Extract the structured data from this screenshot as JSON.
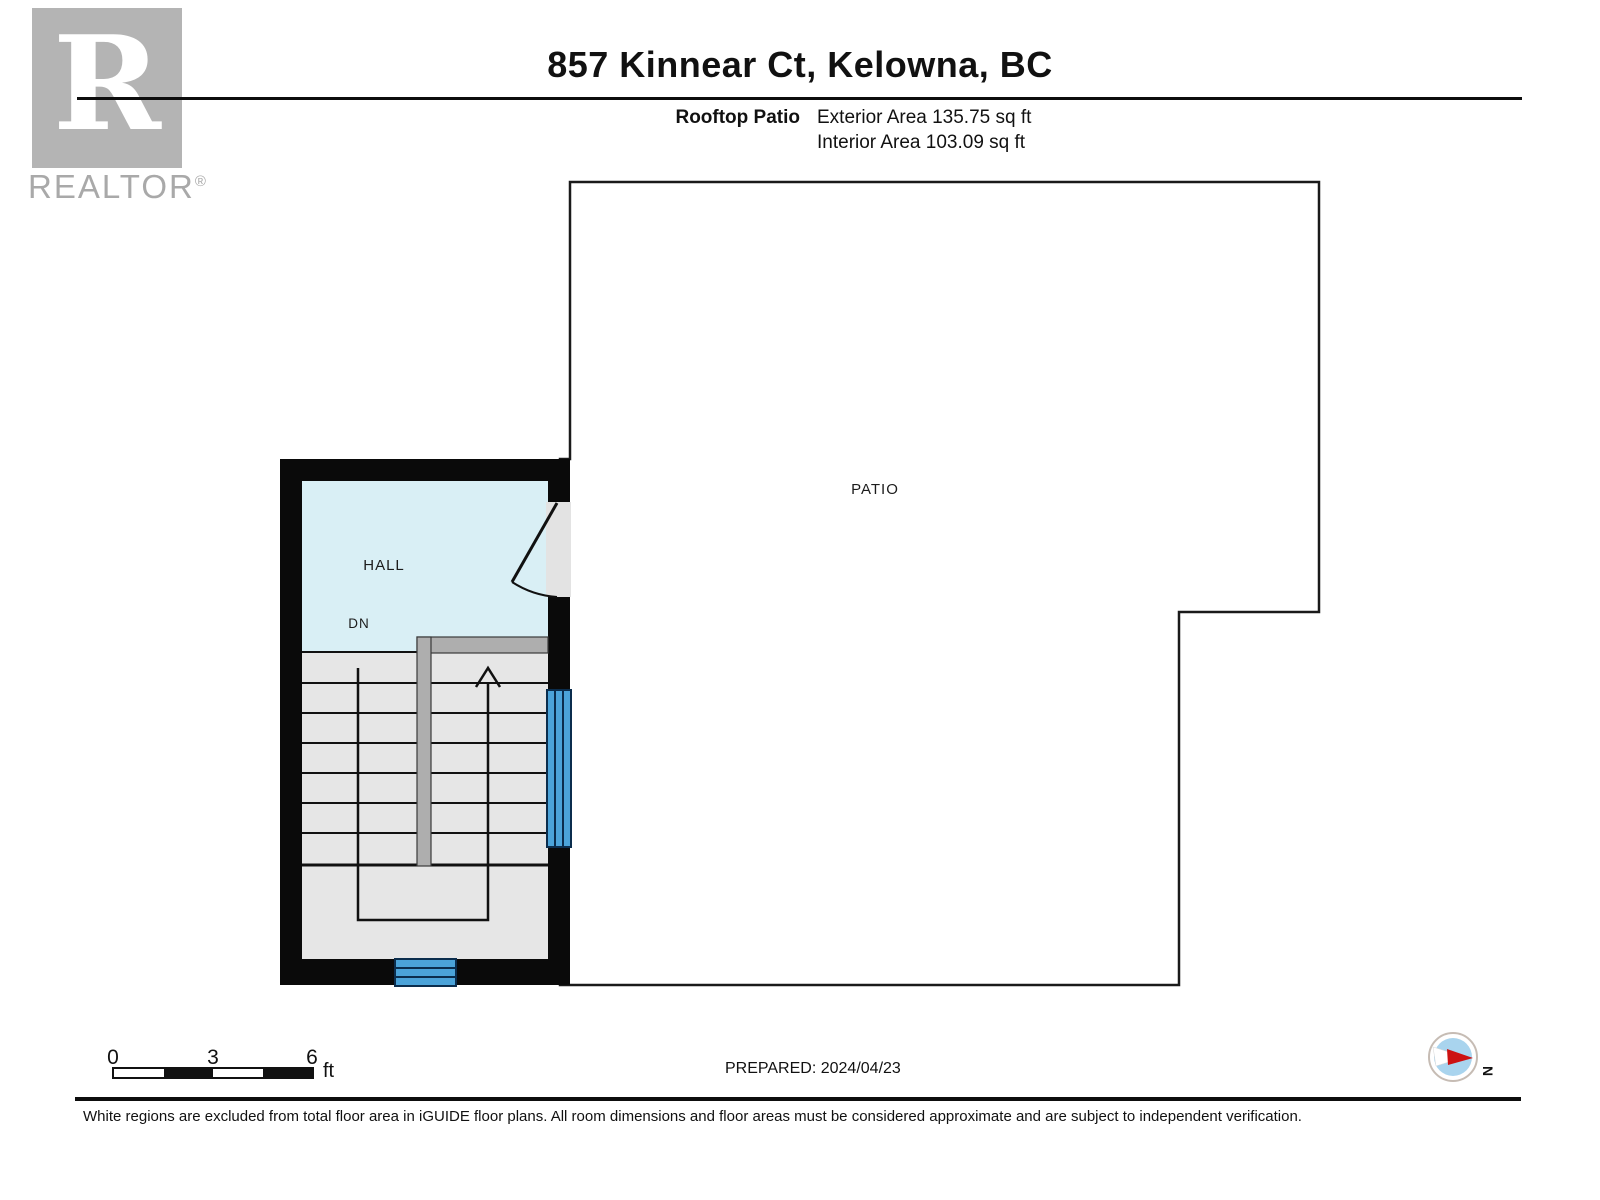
{
  "brand": {
    "name": "REALTOR",
    "registered": "®"
  },
  "header": {
    "title": "857 Kinnear Ct, Kelowna, BC",
    "floor_label": "Rooftop Patio",
    "exterior_area": "Exterior Area 135.75 sq ft",
    "interior_area": "Interior Area 103.09 sq ft"
  },
  "plan": {
    "patio_label": "PATIO",
    "hall_label": "HALL",
    "stair_direction_label": "DN",
    "colors": {
      "wall_black": "#0a0a0a",
      "hall_fill": "#d9eff5",
      "stair_fill": "#e6e6e6",
      "stair_divider_gray": "#aeaeae",
      "window_blue": "#4ba3d9",
      "patio_fill": "#ffffff",
      "door_opening_gray": "#e3e3e3",
      "compass_inner_blue": "#a9d4ee",
      "compass_needle_red": "#cc1111",
      "logo_gray": "#b4b4b4"
    }
  },
  "footer": {
    "scale_bar": {
      "tick_0": "0",
      "tick_3": "3",
      "tick_6": "6",
      "unit": "ft"
    },
    "prepared": "PREPARED: 2024/04/23",
    "compass_north_label": "N",
    "disclaimer": "White regions are excluded from total floor area in iGUIDE floor plans. All room dimensions and floor areas must be considered approximate and are subject to independent verification."
  }
}
